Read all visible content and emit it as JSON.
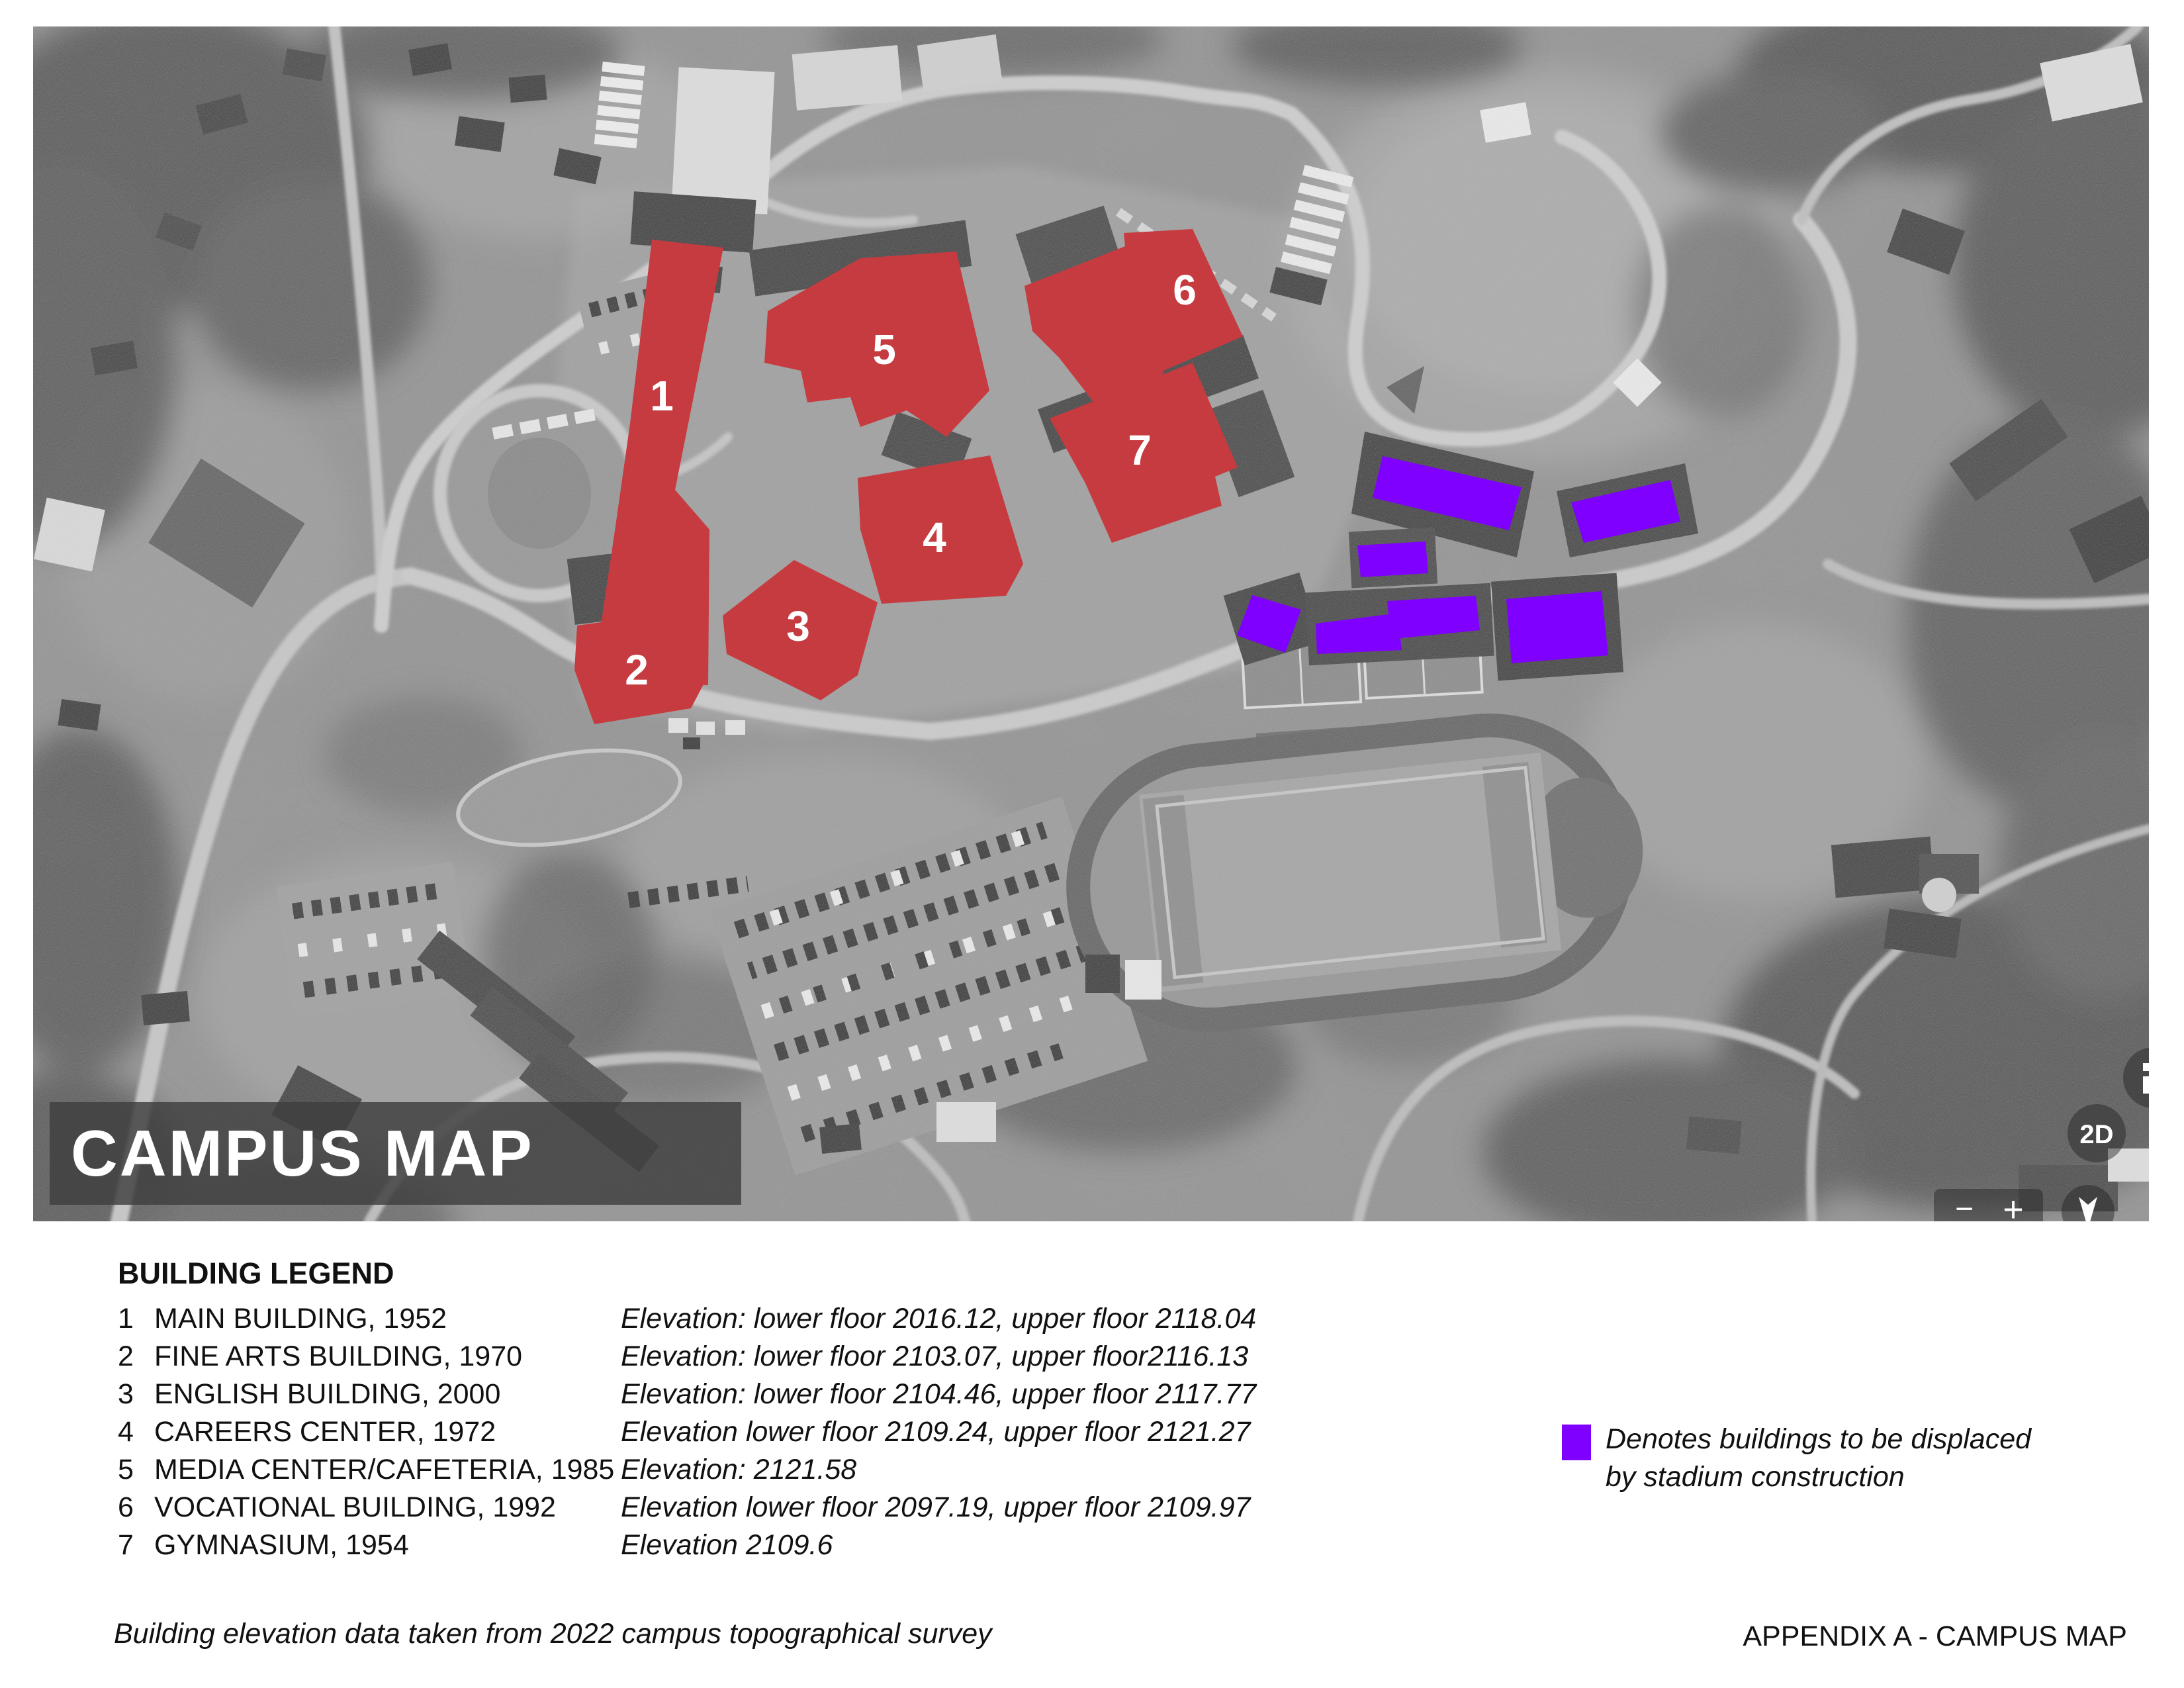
{
  "banner": {
    "title": "CAMPUS MAP"
  },
  "map": {
    "building_labels": [
      "1",
      "2",
      "3",
      "4",
      "5",
      "6",
      "7"
    ],
    "controls": {
      "mode_2d": "2D",
      "zoom_out": "−",
      "zoom_in": "+"
    },
    "colors": {
      "highlight_red": "#c63b40",
      "displaced_purple": "#7f00ff"
    }
  },
  "legend": {
    "heading": "BUILDING LEGEND",
    "buildings": [
      {
        "num": "1",
        "name": "MAIN BUILDING, 1952",
        "elevation": "Elevation: lower floor 2016.12, upper floor 2118.04"
      },
      {
        "num": "2",
        "name": "FINE ARTS BUILDING, 1970",
        "elevation": "Elevation: lower floor 2103.07, upper floor2116.13"
      },
      {
        "num": "3",
        "name": "ENGLISH BUILDING, 2000",
        "elevation": "Elevation: lower floor 2104.46, upper floor 2117.77"
      },
      {
        "num": "4",
        "name": "CAREERS CENTER, 1972",
        "elevation": "Elevation lower floor 2109.24, upper floor 2121.27"
      },
      {
        "num": "5",
        "name": "MEDIA CENTER/CAFETERIA, 1985",
        "elevation": "Elevation: 2121.58"
      },
      {
        "num": "6",
        "name": "VOCATIONAL BUILDING, 1992",
        "elevation": "Elevation lower floor 2097.19, upper floor 2109.97"
      },
      {
        "num": "7",
        "name": "GYMNASIUM, 1954",
        "elevation": "Elevation 2109.6"
      }
    ],
    "displaced_note_line1": "Denotes buildings to be displaced",
    "displaced_note_line2": "by stadium construction"
  },
  "footer": {
    "note": "Building elevation data taken from 2022 campus topographical survey",
    "appendix": "APPENDIX A - CAMPUS MAP"
  }
}
